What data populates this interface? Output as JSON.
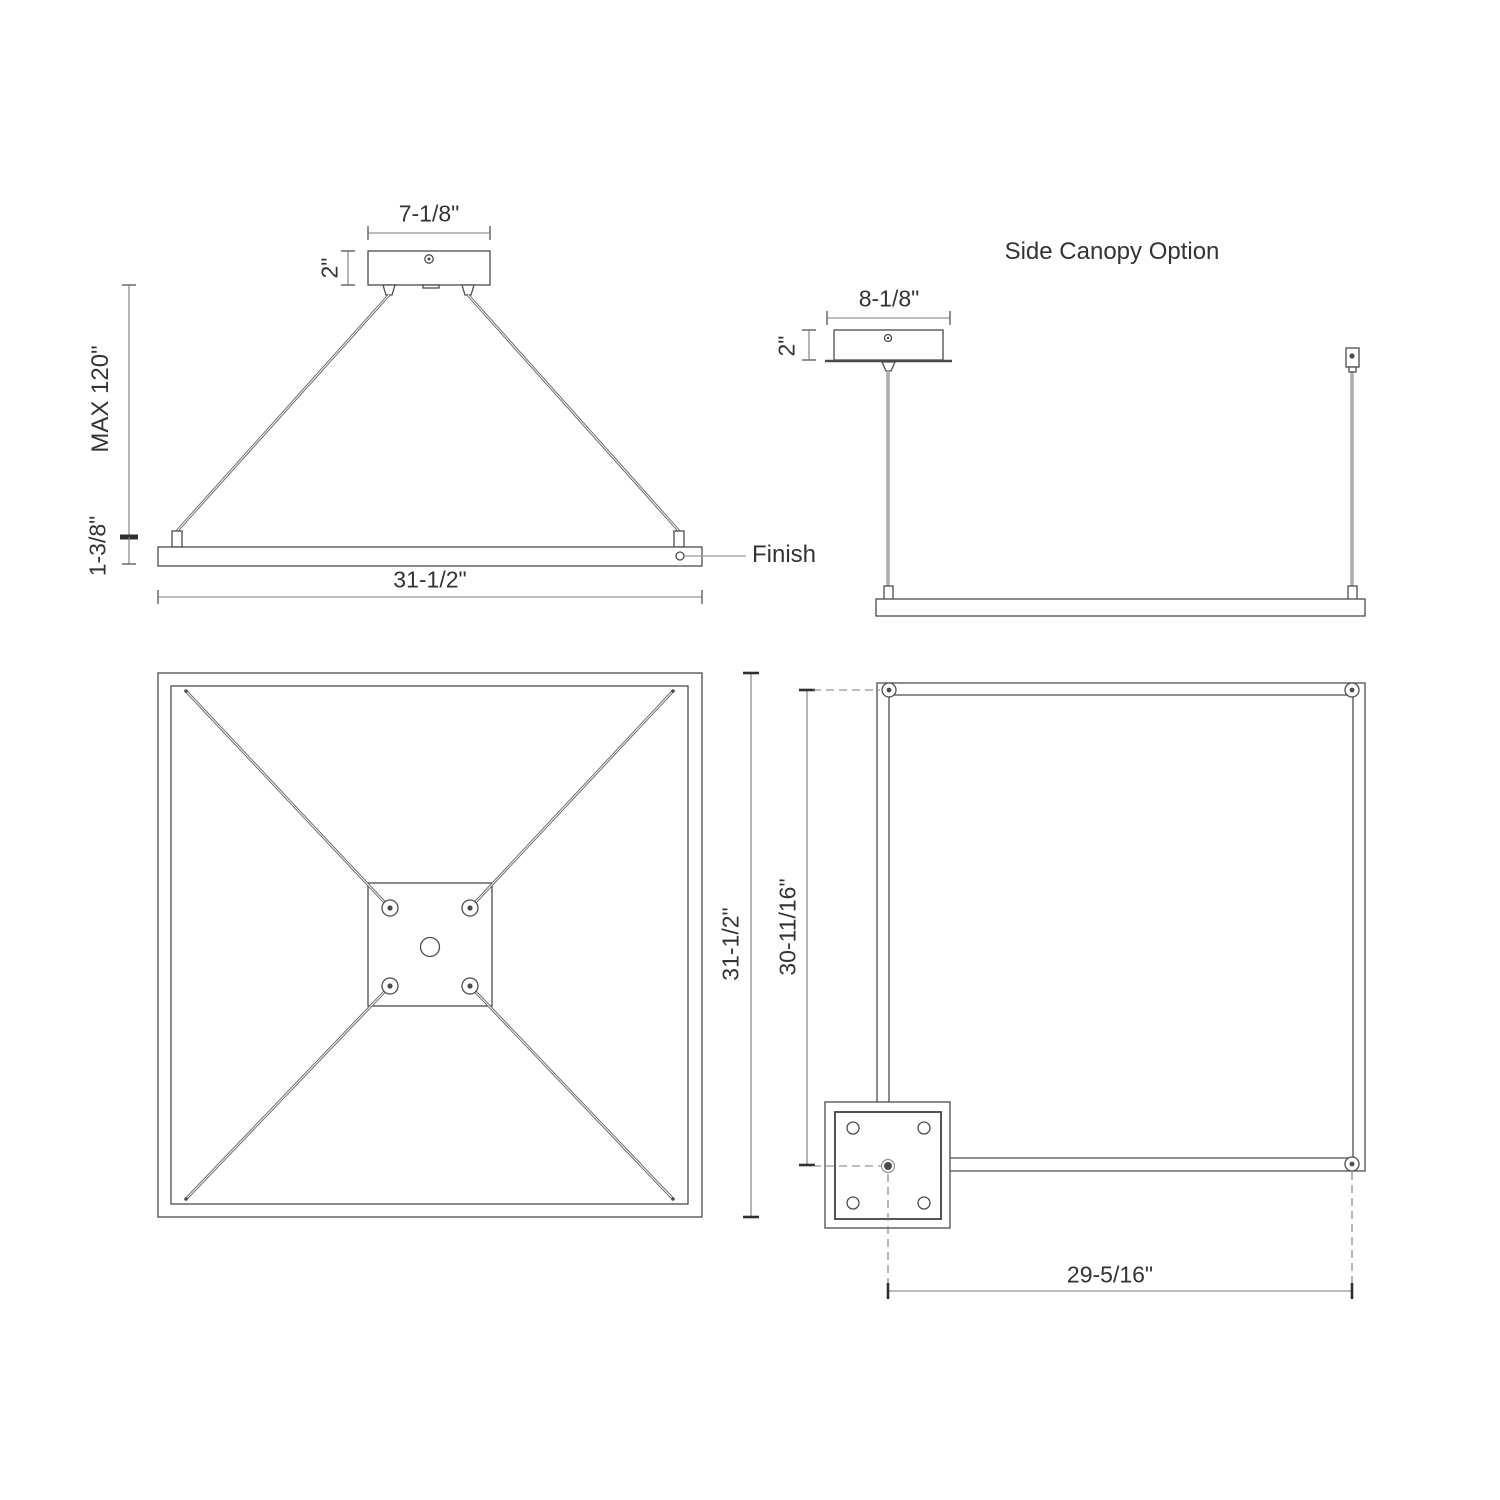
{
  "colors": {
    "line": "#4c4c4c",
    "dimension": "#7a7a7a",
    "tick": "#2f2f2f",
    "text": "#333333",
    "background": "#ffffff",
    "cable": "#5f5f5f",
    "leader": "#9a9a9a"
  },
  "drawing": {
    "front_elevation": {
      "canopy_width": "7-1/8\"",
      "canopy_height": "2\"",
      "max_suspension": "MAX 120\"",
      "frame_thickness": "1-3/8\"",
      "frame_width": "31-1/2\"",
      "finish_label": "Finish"
    },
    "side_canopy_elevation": {
      "title": "Side Canopy Option",
      "canopy_width": "8-1/8\"",
      "canopy_height": "2\""
    },
    "plan_view": {
      "overall_size": "31-1/2\""
    },
    "side_canopy_plan": {
      "attachment_height": "30-11/16\"",
      "attachment_width": "29-5/16\""
    }
  }
}
